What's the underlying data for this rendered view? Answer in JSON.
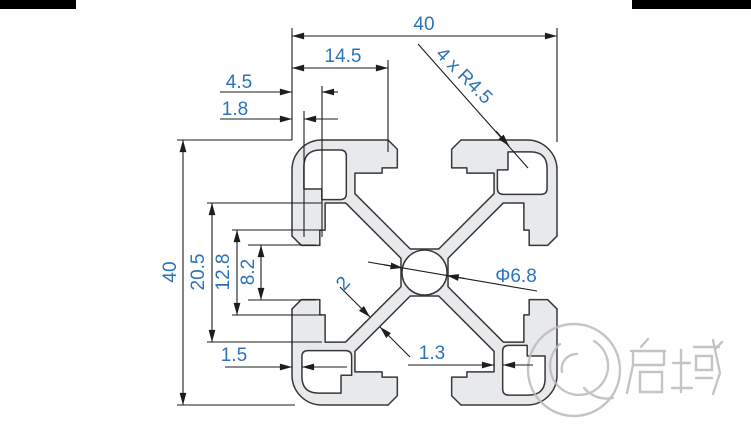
{
  "drawing": {
    "title": "aluminium-profile-4040-cross-section",
    "dims": {
      "width_top": "40",
      "height_left": "40",
      "slot_mouth": "14.5",
      "corner_notch": "4.5",
      "wall_18": "1.8",
      "channel_span": "20.5",
      "slot_cavity": "12.8",
      "slot_opening": "8.2",
      "wall_15": "1.5",
      "wall_13": "1.3",
      "web_thickness": "2",
      "corner_radius": "4 x R4.5",
      "center_hole": "Φ6.8"
    },
    "watermark": {
      "text": "启域"
    },
    "colors": {
      "dimension_text": "#2b74ba",
      "dimension_lines": "#1c1d1f",
      "profile_outline": "#36383c",
      "profile_fill": "#e8e9ea",
      "watermark_gray": "#bcbcbc",
      "border_bar": "#000000"
    }
  }
}
